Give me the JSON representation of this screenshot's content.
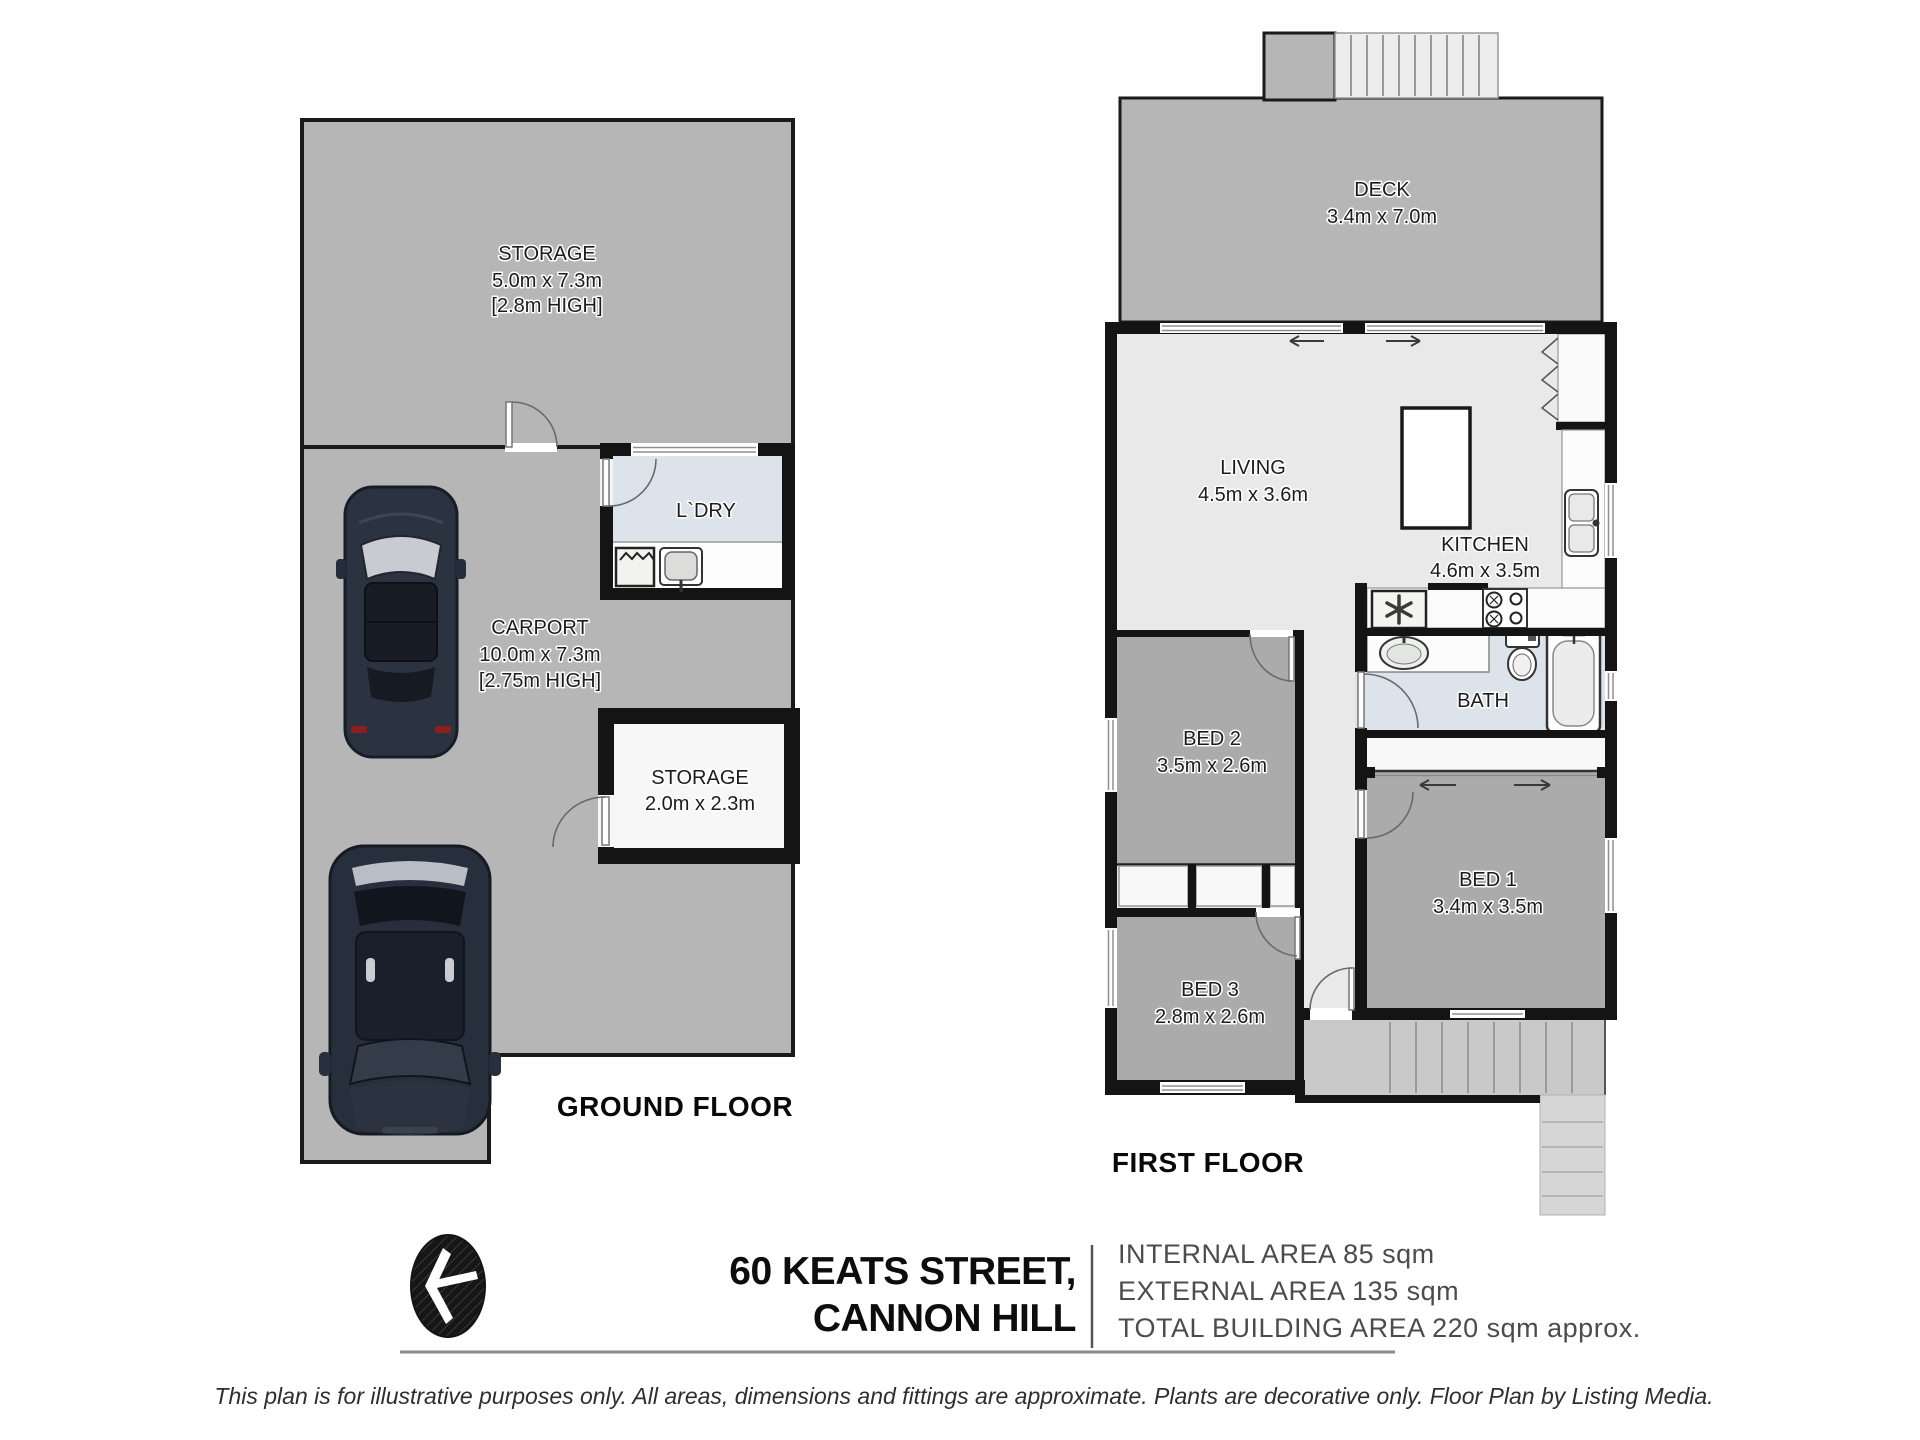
{
  "meta": {
    "document_type": "real-estate floor plan",
    "colors": {
      "wall": "#141414",
      "outdoor_gray": "#b6b6b6",
      "bedroom_gray": "#ababab",
      "living_light": "#e9e9e9",
      "wet_area_blue": "#dce3ea",
      "closet_white": "#f8f8f8",
      "stair_gray": "#c9c9c9"
    },
    "icons": [
      "compass-arrow",
      "car-top-view",
      "washing-machine",
      "laundry-sink",
      "kitchen-sink",
      "stove-cooktop",
      "appliance-asterisk",
      "vanity-sink",
      "toilet",
      "bathtub",
      "stairs",
      "door-swing",
      "window",
      "sliding-door-arrow"
    ]
  },
  "ground_floor": {
    "title": "GROUND FLOOR",
    "storage_top": {
      "name": "STORAGE",
      "dims": "5.0m x 7.3m",
      "height_note": "[2.8m HIGH]"
    },
    "carport": {
      "name": "CARPORT",
      "dims": "10.0m x 7.3m",
      "height_note": "[2.75m HIGH]"
    },
    "laundry": {
      "name": "L`DRY"
    },
    "storage_small": {
      "name": "STORAGE",
      "dims": "2.0m x 2.3m"
    }
  },
  "first_floor": {
    "title": "FIRST FLOOR",
    "deck": {
      "name": "DECK",
      "dims": "3.4m x 7.0m"
    },
    "living": {
      "name": "LIVING",
      "dims": "4.5m x 3.6m"
    },
    "kitchen": {
      "name": "KITCHEN",
      "dims": "4.6m x 3.5m"
    },
    "bath": {
      "name": "BATH"
    },
    "bed1": {
      "name": "BED 1",
      "dims": "3.4m x 3.5m"
    },
    "bed2": {
      "name": "BED 2",
      "dims": "3.5m x 2.6m"
    },
    "bed3": {
      "name": "BED 3",
      "dims": "2.8m x 2.6m"
    }
  },
  "footer": {
    "address_line1": "60 KEATS STREET,",
    "address_line2": "CANNON HILL",
    "internal_area": "INTERNAL AREA 85 sqm",
    "external_area": "EXTERNAL AREA 135 sqm",
    "total_area": "TOTAL BUILDING AREA 220 sqm approx.",
    "disclaimer": "This plan is for illustrative purposes only. All areas, dimensions and fittings are approximate. Plants are decorative only. Floor Plan by Listing Media."
  }
}
